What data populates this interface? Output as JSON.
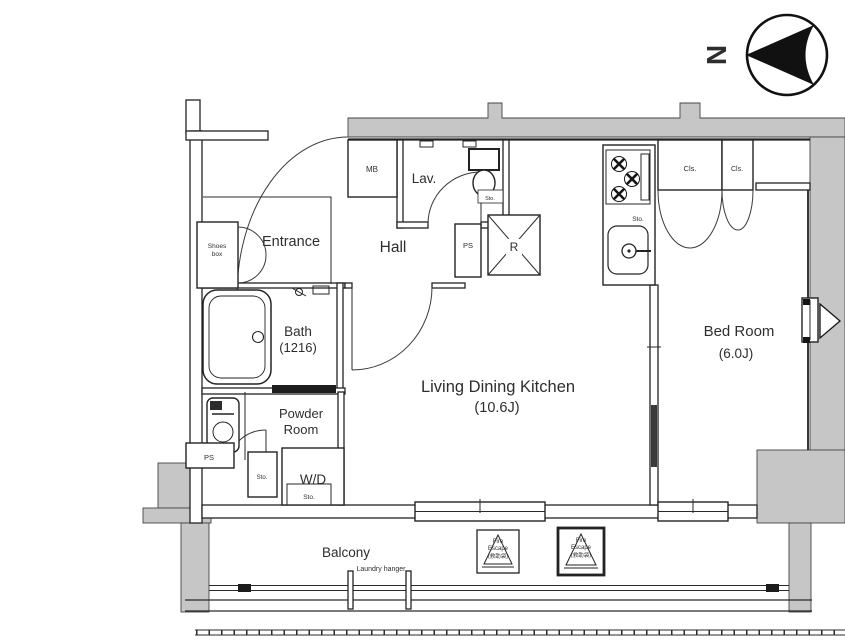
{
  "colors": {
    "wall_fill": "#c6c6c6",
    "line": "#232323",
    "background": "#ffffff"
  },
  "compass": {
    "north": "N"
  },
  "rooms": {
    "entrance": "Entrance",
    "hall": "Hall",
    "lav": "Lav.",
    "bath": "Bath",
    "bath_size": "(1216)",
    "powder_line1": "Powder",
    "powder_line2": "Room",
    "ldk": "Living Dining Kitchen",
    "ldk_size": "(10.6J)",
    "bedroom": "Bed Room",
    "bedroom_size": "(6.0J)",
    "balcony": "Balcony"
  },
  "fixtures": {
    "meter_box": "MB",
    "pipe_space_upper": "PS",
    "pipe_space_lower": "PS",
    "refrigerator": "R",
    "washer_dryer": "W/D",
    "storage_kitchen": "Sto.",
    "storage_lav": "Sto.",
    "storage_powder": "Sto.",
    "storage_wd": "Sto.",
    "shoes_line1": "Shoes",
    "shoes_line2": "box",
    "closet_left": "Cls.",
    "closet_right": "Cls.",
    "laundry_hanger": "Laundry hanger"
  },
  "annotations": {
    "fire_escape_line1": "Fire",
    "fire_escape_line2": "Escape",
    "fire_escape_line3": "(救助袋)"
  }
}
